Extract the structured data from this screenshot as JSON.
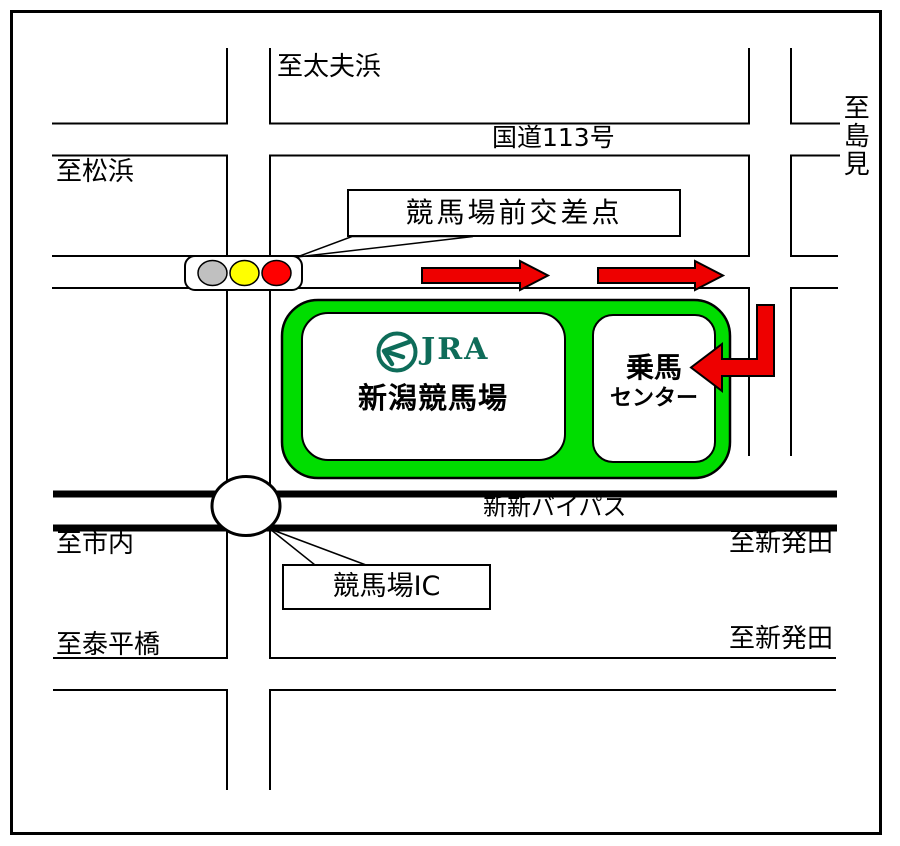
{
  "map": {
    "region_labels": {
      "to_tayuhama": "至太夫浜",
      "to_matsuhama": "至松浜",
      "to_shimami": "至島見",
      "to_shinai": "至市内",
      "to_shibata_upper": "至新発田",
      "to_shibata_lower": "至新発田",
      "to_taiheibashi": "至泰平橋"
    },
    "road_names": {
      "route_113": "国道113号",
      "shinshin_bypass": "新新バイパス"
    },
    "callouts": {
      "intersection": "競馬場前交差点",
      "interchange": "競馬場IC"
    },
    "facilities": {
      "jra_logo_text": "JRA",
      "racecourse_name": "新潟競馬場",
      "riding_center_line1": "乗馬",
      "riding_center_line2": "センター"
    },
    "colors": {
      "facility_green": "#00DD00",
      "arrow_red": "#EE0000",
      "jra_green": "#0E6C59",
      "signal_gray": "#C0C0C0",
      "signal_yellow": "#FFFF00",
      "signal_red": "#FF0000",
      "road_line_black": "#000000"
    }
  }
}
